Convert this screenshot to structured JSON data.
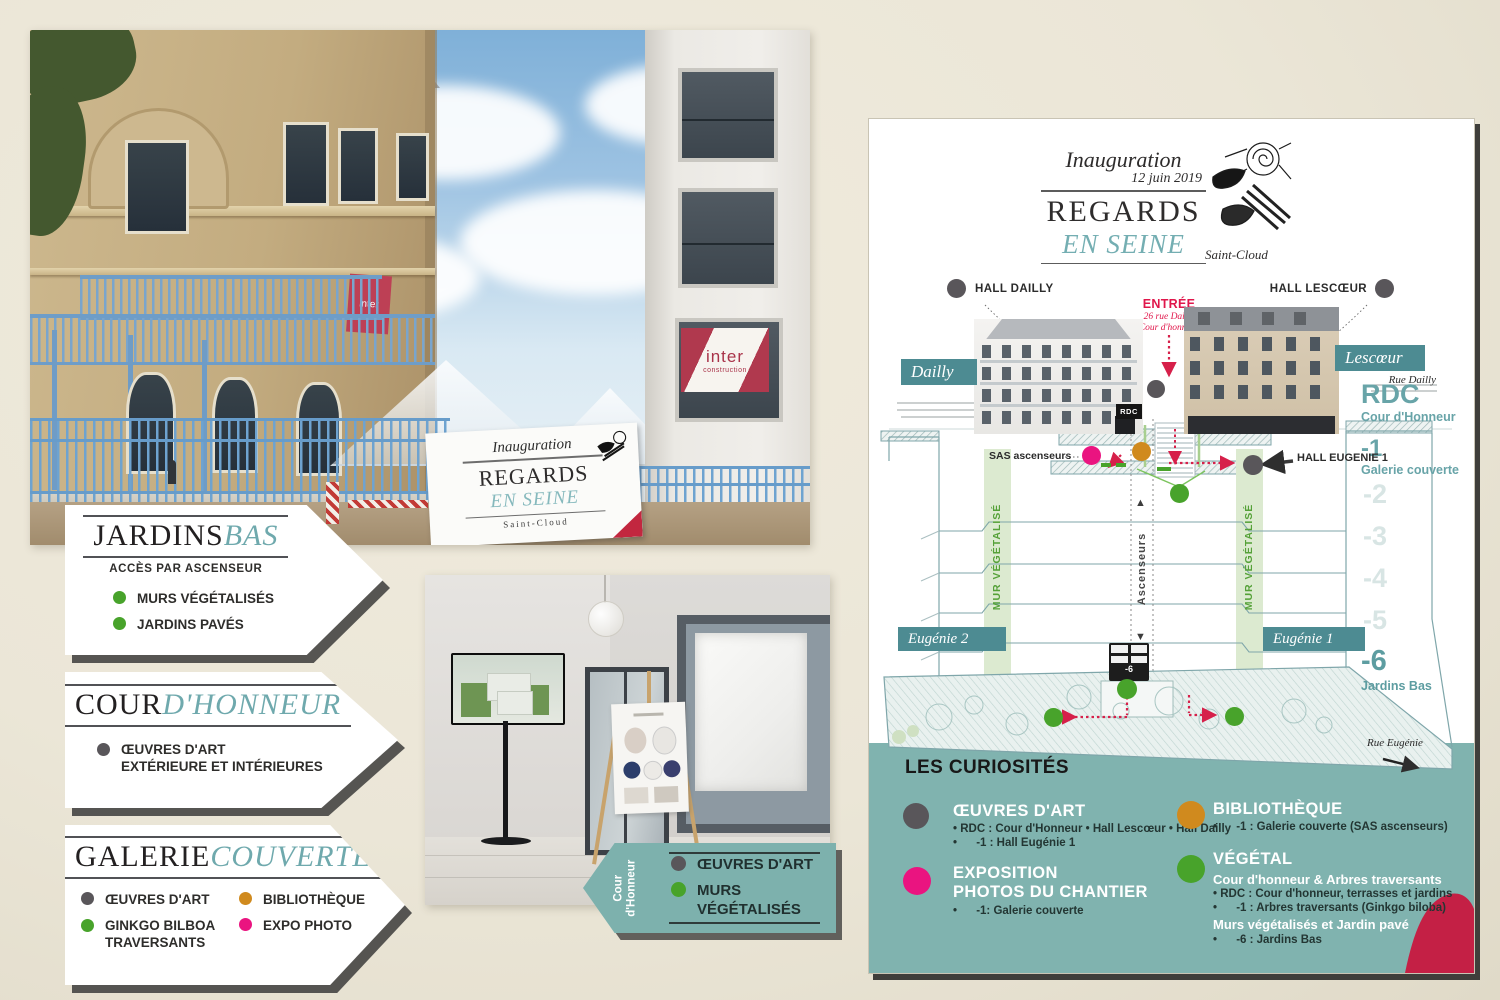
{
  "colors": {
    "teal_box": "#4d8b92",
    "teal_band": "#80b3af",
    "teal_accent": "#6fa9ad",
    "green": "#48a32b",
    "gray": "#59565a",
    "orange": "#d08a1e",
    "pink": "#ea1480",
    "red": "#d6204a",
    "crimson_corner": "#c42045"
  },
  "photo_street": {
    "balcony_flag": "inter",
    "window_sign_line1": "inter",
    "window_sign_line2": "construction",
    "banner": {
      "l1": "Inauguration",
      "l2": "REGARDS",
      "l3": "EN SEINE",
      "l4": "Saint-Cloud"
    }
  },
  "tag_jardins": {
    "title_main": "JARDINS",
    "title_accent": "BAS",
    "subtitle": "ACCÈS PAR ASCENSEUR",
    "item1": "MURS VÉGÉTALISÉS",
    "item2": "JARDINS PAVÉS"
  },
  "tag_cour": {
    "title_main": "COUR",
    "title_accent": "D'HONNEUR",
    "item1_line1": "ŒUVRES D'ART",
    "item1_line2": "EXTÉRIEURE ET INTÉRIEURES"
  },
  "tag_galerie": {
    "title_main": "GALERIE",
    "title_accent": "COUVERTE",
    "item1": "ŒUVRES D'ART",
    "item2": "BIBLIOTHÈQUE",
    "item3_line1": "GINKGO BILBOA",
    "item3_line2": "TRAVERSANTS",
    "item4": "EXPO PHOTO"
  },
  "tag_teal": {
    "side1": "Cour",
    "side2": "d'Honneur",
    "item1": "ŒUVRES D'ART",
    "item2": "MURS VÉGÉTALISÉS"
  },
  "poster": {
    "header": {
      "kicker": "Inauguration",
      "date": "12 juin 2019",
      "title": "REGARDS",
      "subtitle": "EN SEINE",
      "city": "Saint-Cloud"
    },
    "map": {
      "hall_dailly": "HALL DAILLY",
      "hall_lescoeur": "HALL LESCŒUR",
      "dailly": "Dailly",
      "lescoeur": "Lescœur",
      "entree": "ENTRÉE",
      "entree_l1": "26 rue Dailly",
      "entree_l2": "Cour d'honneur",
      "rue_dailly": "Rue Dailly",
      "rue_eugenie": "Rue Eugénie",
      "rdc_door": "RDC",
      "sas": "SAS ascenseurs",
      "hall_eugenie": "HALL EUGENIE 1",
      "mur_vegetalise": "MUR VÉGÉTALISÉ",
      "ascenseurs": "Ascenseurs",
      "eugenie2": "Eugénie 2",
      "eugenie1": "Eugénie 1",
      "lift_label": "-6"
    },
    "floors": {
      "rdc": "RDC",
      "rdc_label": "Cour d'Honneur",
      "m1": "-1",
      "m1_label": "Galerie couverte",
      "m2": "-2",
      "m3": "-3",
      "m4": "-4",
      "m5": "-5",
      "m6": "-6",
      "m6_label": "Jardins Bas"
    },
    "legend": {
      "title": "LES CURIOSITÉS",
      "oeuvres_title": "ŒUVRES D'ART",
      "oeuvres_l1": "• RDC : Cour d'Honneur • Hall Lescœur • Hall Dailly",
      "oeuvres_l2": "•      -1 : Hall Eugénie 1",
      "expo_title1": "EXPOSITION",
      "expo_title2": "PHOTOS DU CHANTIER",
      "expo_l1": "•      -1: Galerie couverte",
      "biblio_title": "BIBLIOTHÈQUE",
      "biblio_l1": "•      -1 : Galerie couverte (SAS ascenseurs)",
      "vegetal_title": "VÉGÉTAL",
      "vegetal_sub1": "Cour d'honneur & Arbres traversants",
      "vegetal_l1": "• RDC : Cour d'honneur, terrasses et jardins",
      "vegetal_l2": "•      -1 : Arbres traversants (Ginkgo biloba)",
      "vegetal_sub2": "Murs végétalisés et Jardin pavé",
      "vegetal_l3": "•      -6 : Jardins Bas"
    }
  }
}
